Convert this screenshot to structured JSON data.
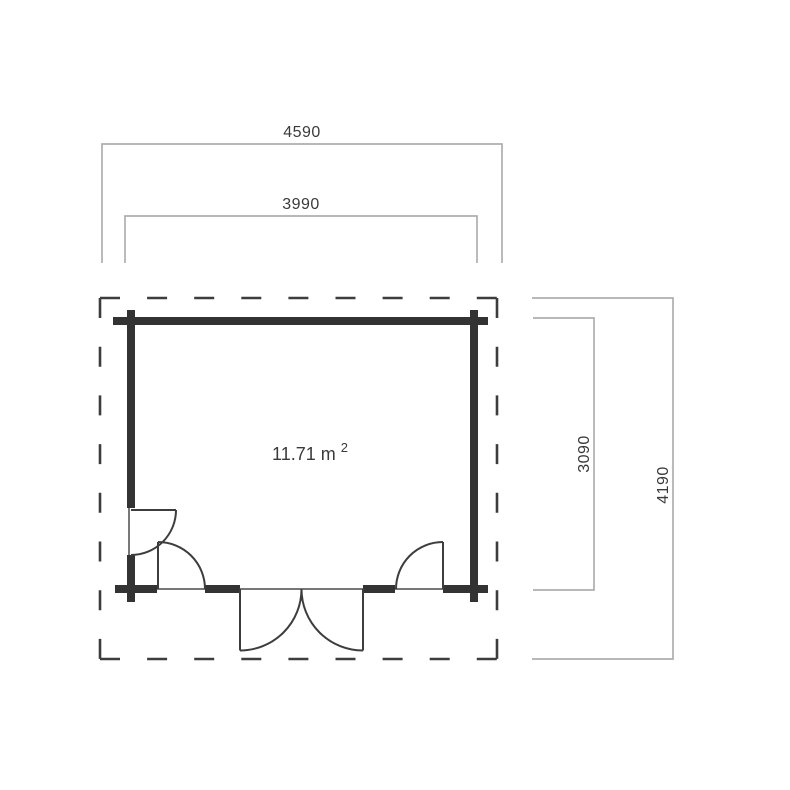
{
  "floorplan": {
    "area": {
      "text": "11.71 m",
      "superscript": "2"
    },
    "dimensions": {
      "roof_width": "4590",
      "wall_width": "3990",
      "wall_depth": "3090",
      "roof_depth": "4190"
    },
    "colors": {
      "background": "#ffffff",
      "wall": "#333333",
      "outline": "#3d3d3d",
      "door": "#3d3d3d",
      "threshold": "#4a4a4a",
      "dimension_line": "#aeaeae",
      "text": "#3a3a3a"
    }
  }
}
